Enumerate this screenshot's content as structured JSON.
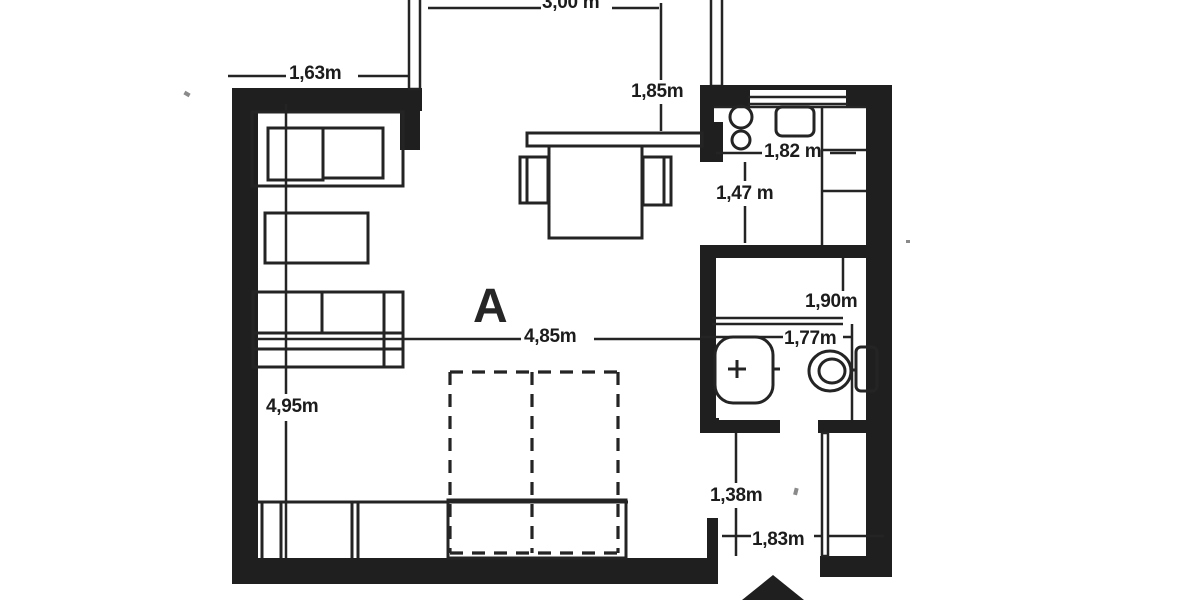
{
  "colors": {
    "ink": "#222222",
    "paper": "#ffffff"
  },
  "floor_plan": {
    "room_label": "A",
    "labels": {
      "balcony_width": "3,00 m",
      "upper_left_wall_width": "1,63m",
      "dining_area_depth": "1,85m",
      "kitchen_width": "1,82 m",
      "kitchen_passage_depth": "1,47 m",
      "bathroom_upper_width": "1,90m",
      "bathroom_lower_width": "1,77m",
      "living_room_width": "4,85m",
      "living_room_depth": "4,95m",
      "hallway_depth": "1,38m",
      "hallway_width": "1,83m"
    }
  }
}
